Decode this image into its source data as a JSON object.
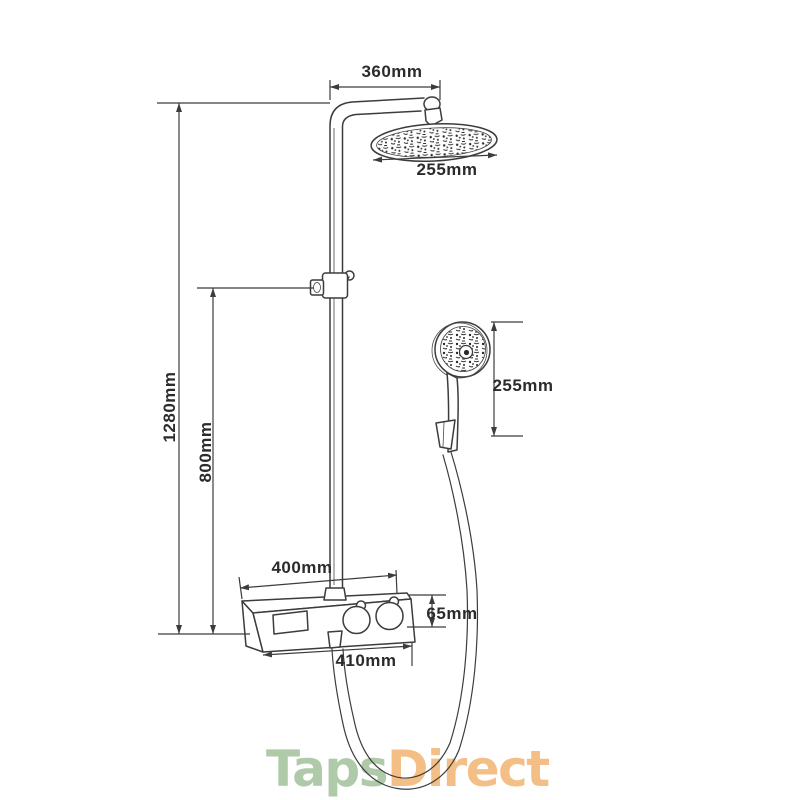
{
  "diagram": {
    "description_labels": {
      "arm_projection": "360mm",
      "rain_head_width": "255mm",
      "total_height": "1280mm",
      "rail_height": "800mm",
      "hand_shower_height": "255mm",
      "valve_top_width": "400mm",
      "valve_height": "65mm",
      "valve_bottom_width": "410mm"
    },
    "line_color": "#3c3c3c",
    "text_color": "#2b2b2b"
  },
  "logo": {
    "taps_text": "Taps",
    "direct_text": "Direct",
    "taps_color": "#aecaa8",
    "direct_color": "#f4bf87"
  }
}
